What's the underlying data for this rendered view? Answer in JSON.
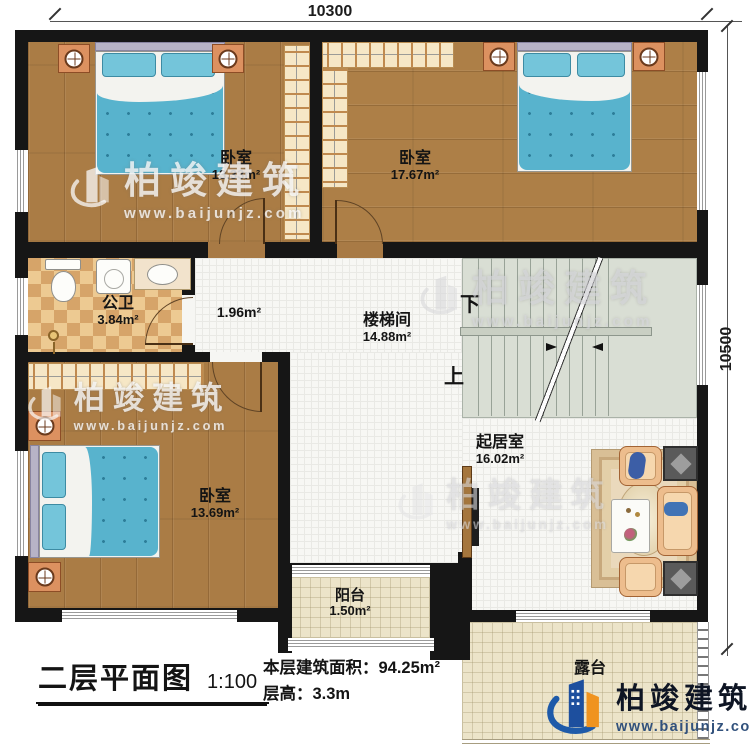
{
  "meta": {
    "plan_title": "二层平面图",
    "scale": "1:100"
  },
  "dimensions": {
    "top": "10300",
    "right": "10500"
  },
  "info": {
    "area_label": "本层建筑面积：",
    "area_value": "94.25m²",
    "height_label": "层高：",
    "height_value": "3.3m"
  },
  "rooms": {
    "bedroom_tl": {
      "name": "卧室",
      "area": "13.33m²"
    },
    "bedroom_tr": {
      "name": "卧室",
      "area": "17.67m²"
    },
    "bathroom": {
      "name": "公卫",
      "area": "3.84m²"
    },
    "hall": {
      "area": "1.96m²"
    },
    "stairwell": {
      "name": "楼梯间",
      "area": "14.88m²"
    },
    "living": {
      "name": "起居室",
      "area": "16.02m²"
    },
    "bedroom_bl": {
      "name": "卧室",
      "area": "13.69m²"
    },
    "balcony": {
      "name": "阳台",
      "area": "1.50m²"
    },
    "terrace": {
      "name": "露台"
    }
  },
  "stairs": {
    "down": "下",
    "up": "上"
  },
  "watermark": {
    "brand": "柏竣建筑",
    "url": "www.baijunjz.com"
  },
  "logo": {
    "brand": "柏竣建筑",
    "url": "www.baijunjz.com"
  },
  "colors": {
    "wall": "#161616",
    "wood": "#aa7c45",
    "blanket_blue": "#58b3cd",
    "checker_tan": "#d6a469",
    "logo_blue": "#1d4f9e",
    "logo_orange": "#f0931f"
  }
}
